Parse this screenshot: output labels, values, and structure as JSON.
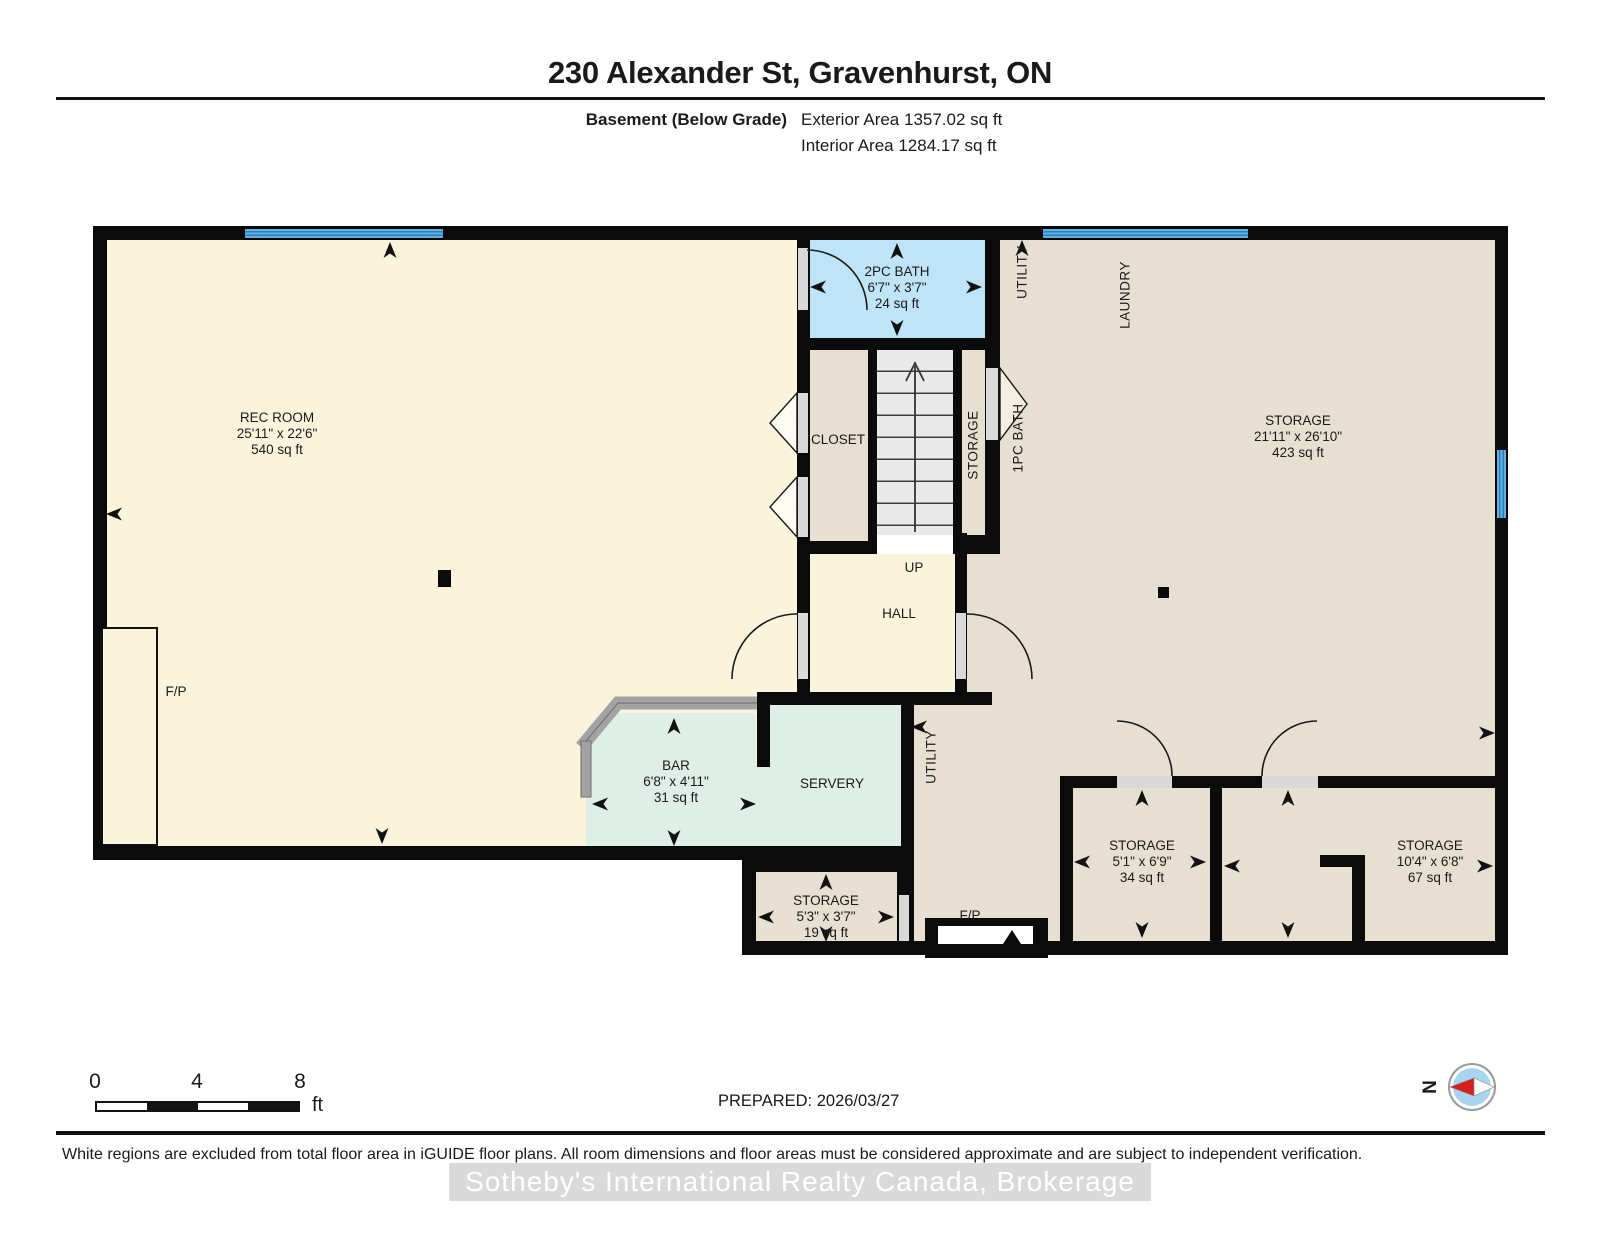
{
  "header": {
    "title": "230 Alexander St, Gravenhurst, ON",
    "floor_label": "Basement (Below Grade)",
    "exterior_area": "Exterior Area 1357.02 sq ft",
    "interior_area": "Interior Area 1284.17 sq ft"
  },
  "rooms": {
    "rec_room": {
      "name": "REC ROOM",
      "dims": "25'11\" x 22'6\"",
      "area": "540 sq ft"
    },
    "bath_2pc": {
      "name": "2PC BATH",
      "dims": "6'7\" x 3'7\"",
      "area": "24 sq ft"
    },
    "closet": {
      "name": "CLOSET"
    },
    "stair_storage": {
      "name": "STORAGE"
    },
    "bath_1pc": {
      "name": "1PC BATH"
    },
    "utility_upper": {
      "name": "UTILITY"
    },
    "laundry": {
      "name": "LAUNDRY"
    },
    "storage_main": {
      "name": "STORAGE",
      "dims": "21'11\" x 26'10\"",
      "area": "423 sq ft"
    },
    "hall": {
      "name": "HALL",
      "direction": "UP"
    },
    "bar": {
      "name": "BAR",
      "dims": "6'8\" x 4'11\"",
      "area": "31 sq ft"
    },
    "servery": {
      "name": "SERVERY"
    },
    "utility_lower": {
      "name": "UTILITY"
    },
    "fireplace_left": {
      "name": "F/P"
    },
    "fireplace_lower": {
      "name": "F/P"
    },
    "storage_small": {
      "name": "STORAGE",
      "dims": "5'3\" x 3'7\"",
      "area": "19 sq ft"
    },
    "storage_mid": {
      "name": "STORAGE",
      "dims": "5'1\" x 6'9\"",
      "area": "34 sq ft"
    },
    "storage_right": {
      "name": "STORAGE",
      "dims": "10'4\" x 6'8\"",
      "area": "67 sq ft"
    }
  },
  "footer": {
    "scale": {
      "ticks": [
        "0",
        "4",
        "8"
      ],
      "unit": "ft"
    },
    "prepared": "PREPARED: 2026/03/27",
    "compass_north": "N",
    "disclaimer": "White regions are excluded from total floor area in iGUIDE floor plans. All room dimensions and floor areas must be considered approximate and are subject to independent verification.",
    "watermark": "Sotheby's International Realty Canada, Brokerage"
  },
  "colors": {
    "wall": "#0b0b0b",
    "rec_cream": "#fbf4dd",
    "beige": "#e7dfd2",
    "bath_blue": "#bfe3f7",
    "mint": "#dfeee6",
    "window_blue": "#5fb2e4",
    "window_stripe": "#2d7cb7",
    "stair_grey": "#e9e9e9",
    "door_grey": "#d9d9d9",
    "counter_grey": "#a3a3a3",
    "compass_blue": "#a9d4f0",
    "compass_red": "#d81f1f",
    "watermark_grey": "#d6d6d6"
  }
}
